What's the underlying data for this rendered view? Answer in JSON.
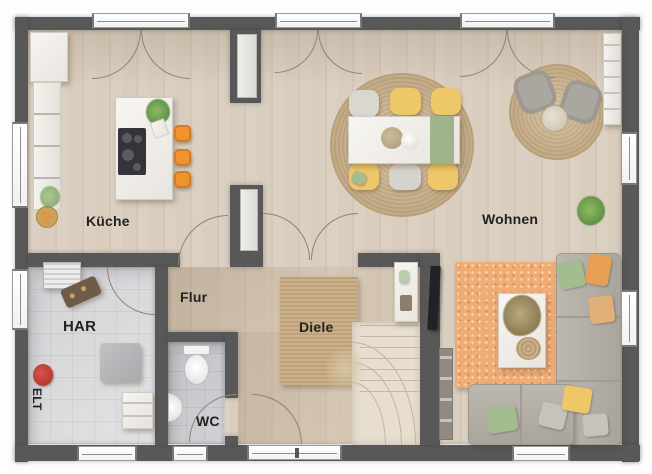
{
  "rooms": {
    "kueche": "Küche",
    "wohnen": "Wohnen",
    "flur": "Flur",
    "diele": "Diele",
    "har": "HAR",
    "wc": "WC",
    "elt": "ELT"
  },
  "palette": {
    "wall": "#585858",
    "floor_wood": "#d9cdbe",
    "hall_tint": "#d5c5b0",
    "tile_har": "#dcdcde",
    "tile_wc": "#c7c7cb",
    "jute_rug": "#c4a983",
    "rug_orange": "#efac74",
    "sofa_gray": "#b7b3ab",
    "accent_orange": "#f0932f",
    "accent_yellow": "#eec768",
    "accent_green": "#a4bd90",
    "window_white": "#ffffff",
    "door_arc": "#8d8376"
  }
}
